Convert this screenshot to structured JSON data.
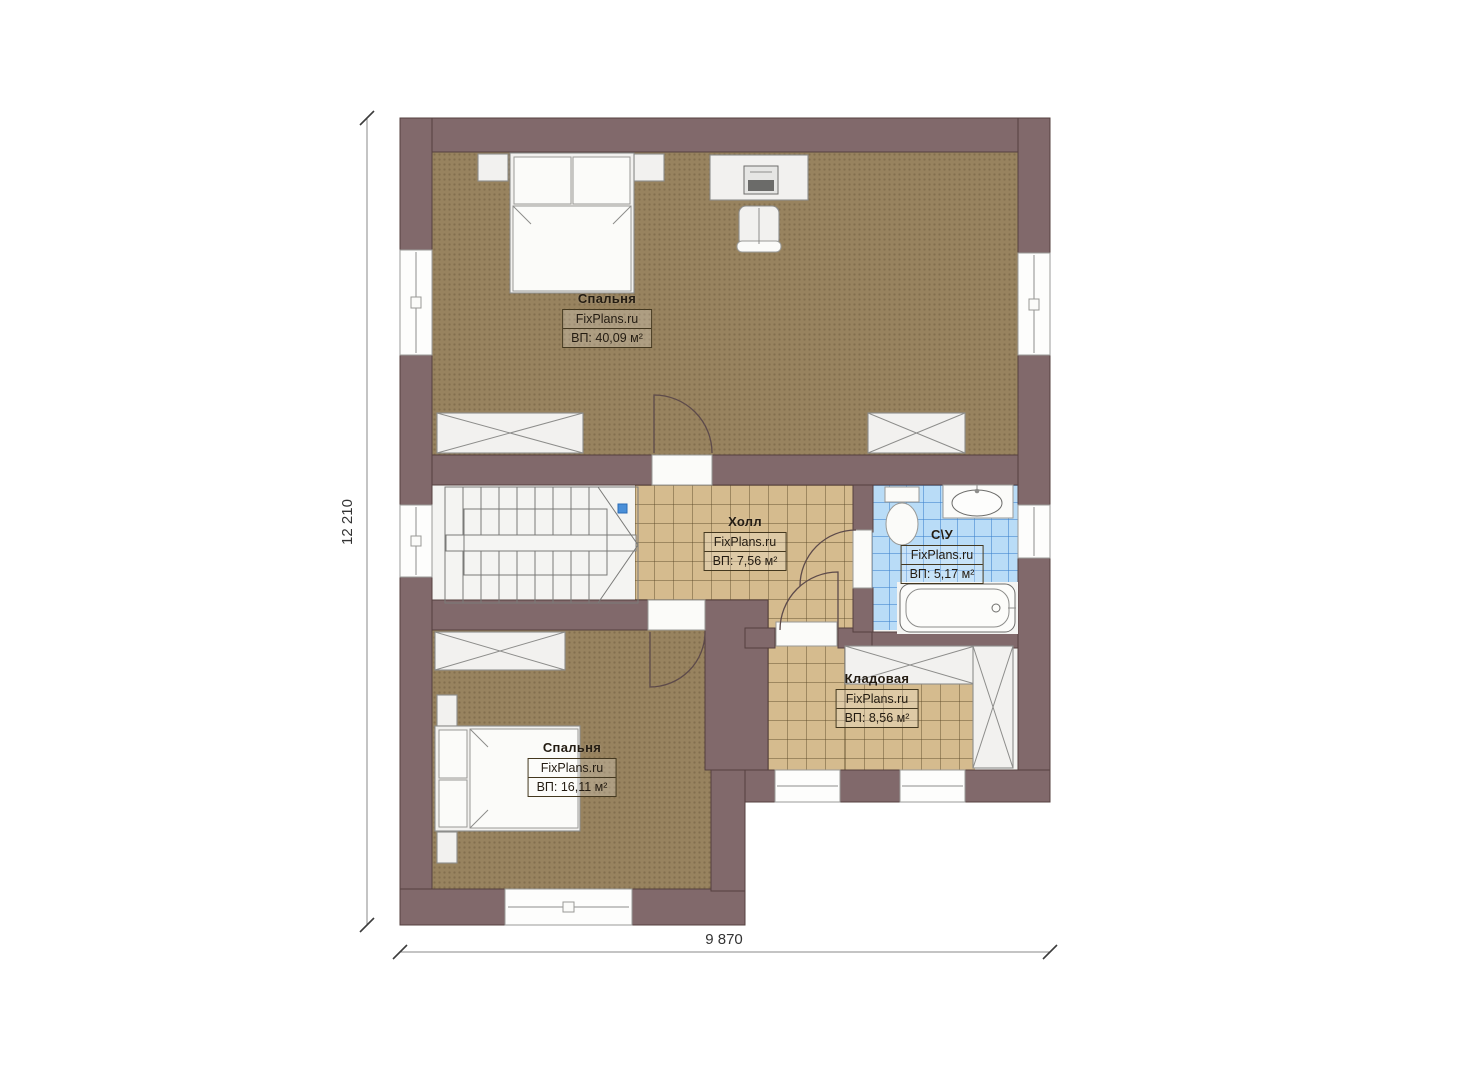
{
  "plan": {
    "type": "floor-plan",
    "watermark": "FixPlans.ru",
    "rooms": [
      {
        "name": "Спальня",
        "watermark": "FixPlans.ru",
        "area": "ВП: 40,09 м²"
      },
      {
        "name": "Холл",
        "watermark": "FixPlans.ru",
        "area": "ВП: 7,56 м²"
      },
      {
        "name": "С\\У",
        "watermark": "FixPlans.ru",
        "area": "ВП: 5,17 м²"
      },
      {
        "name": "Кладовая",
        "watermark": "FixPlans.ru",
        "area": "ВП: 8,56 м²"
      },
      {
        "name": "Спальня",
        "watermark": "FixPlans.ru",
        "area": "ВП: 16,11 м²"
      }
    ],
    "dimensions": {
      "width": "9 870",
      "height": "12 210"
    },
    "colors": {
      "wall": "#81696b",
      "carpet": "#98835f",
      "tile_tan": "#d5bb8e",
      "tile_blue": "#b9dcf7",
      "furniture": "#f2f1ef",
      "background": "#ffffff"
    }
  }
}
